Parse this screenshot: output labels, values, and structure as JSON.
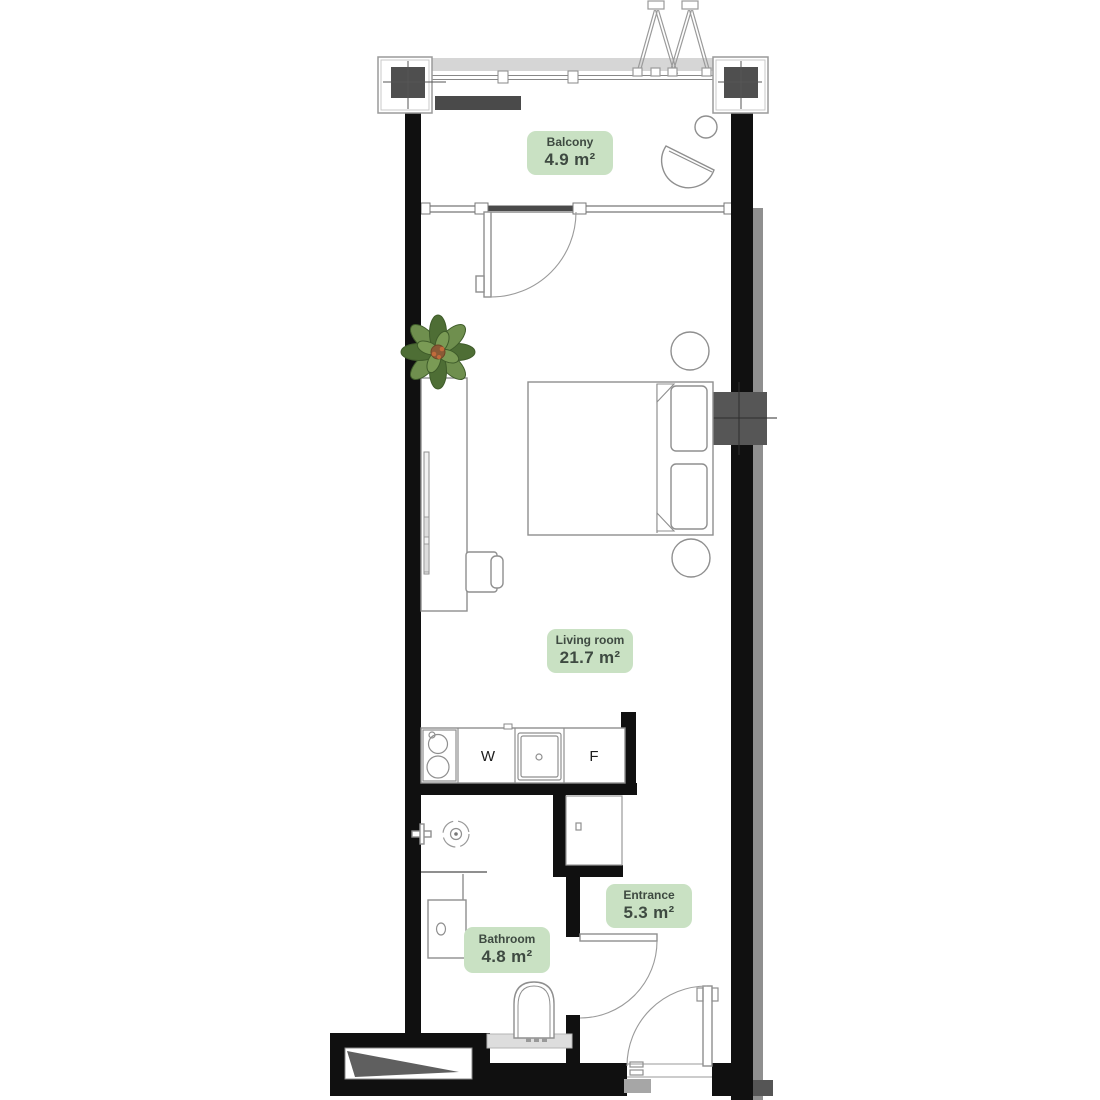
{
  "plan": {
    "title": "Studio apartment floor plan",
    "rooms": [
      {
        "name": "Balcony",
        "area": "4.9 m²"
      },
      {
        "name": "Living room",
        "area": "21.7 m²"
      },
      {
        "name": "Entrance",
        "area": "5.3 m²"
      },
      {
        "name": "Bathroom",
        "area": "4.8 m²"
      }
    ],
    "appliances": {
      "washer": "W",
      "fridge": "F"
    },
    "colors": {
      "label_bg": "#c9e1c3",
      "label_text": "#3e4a41",
      "wall": "#101010",
      "column_fill": "#4f4f4f",
      "outline_gray": "#8f8f8f",
      "balcony_band": "#d6d6d6",
      "cistern_band": "#dddddd",
      "plant_green": "#6f8f4e",
      "floor": "#ffffff"
    },
    "icons": [
      "plant-icon",
      "shower-head-icon",
      "cooktop-icon",
      "sink-icon",
      "toilet-icon",
      "armchair-icon",
      "column-marker-icon",
      "door-swing-icon",
      "ladder-icon"
    ]
  }
}
